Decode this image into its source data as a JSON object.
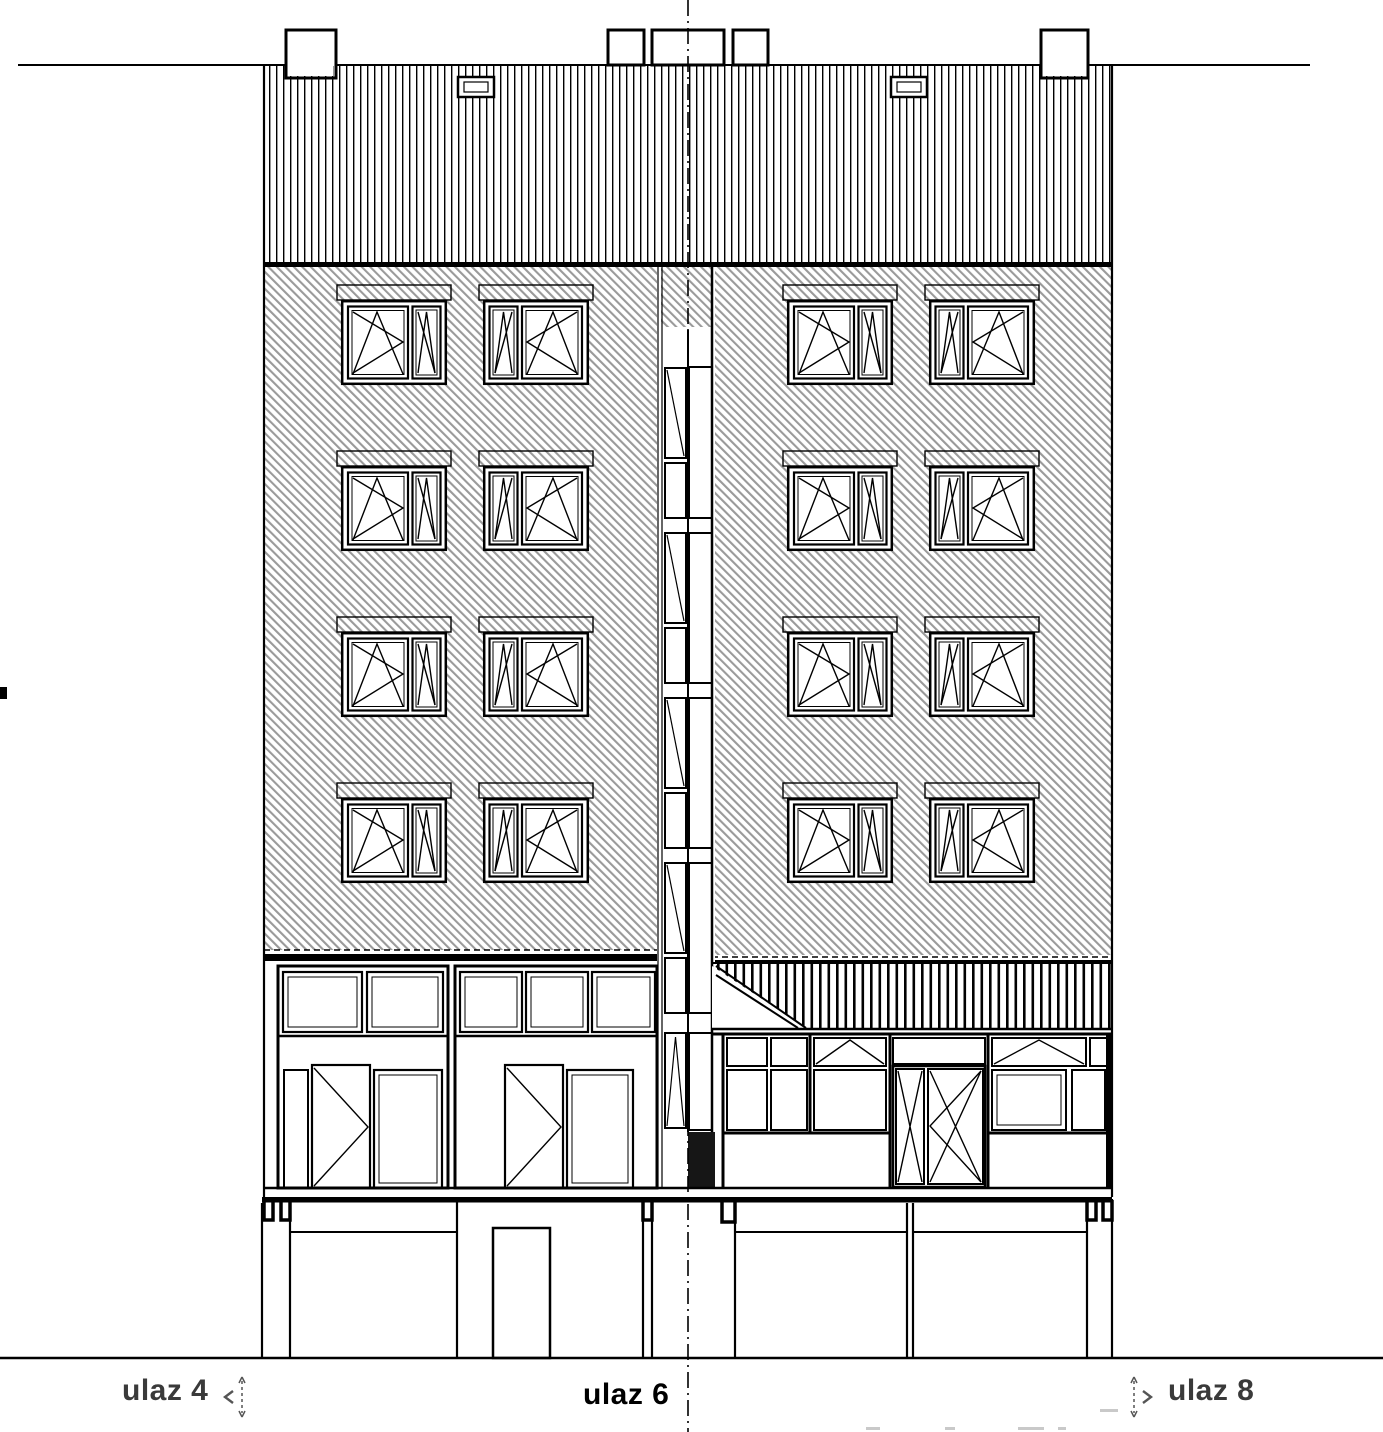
{
  "labels": {
    "entrance_left": "ulaz 4",
    "entrance_center": "ulaz 6",
    "entrance_right": "ulaz 8"
  },
  "markers": {
    "left": "section-reference-arrow-left",
    "right": "section-reference-arrow-right"
  },
  "colors": {
    "background": "#ffffff",
    "lines": "#000000",
    "facade_hatch": "#9a9a9a",
    "side_label_text": "#3a3a3a",
    "center_label_text": "#000000"
  },
  "elevation": {
    "upper_window_rows": 4,
    "windows_per_row": 4,
    "entrances_labeled": [
      "ulaz 4",
      "ulaz 6",
      "ulaz 8"
    ]
  }
}
